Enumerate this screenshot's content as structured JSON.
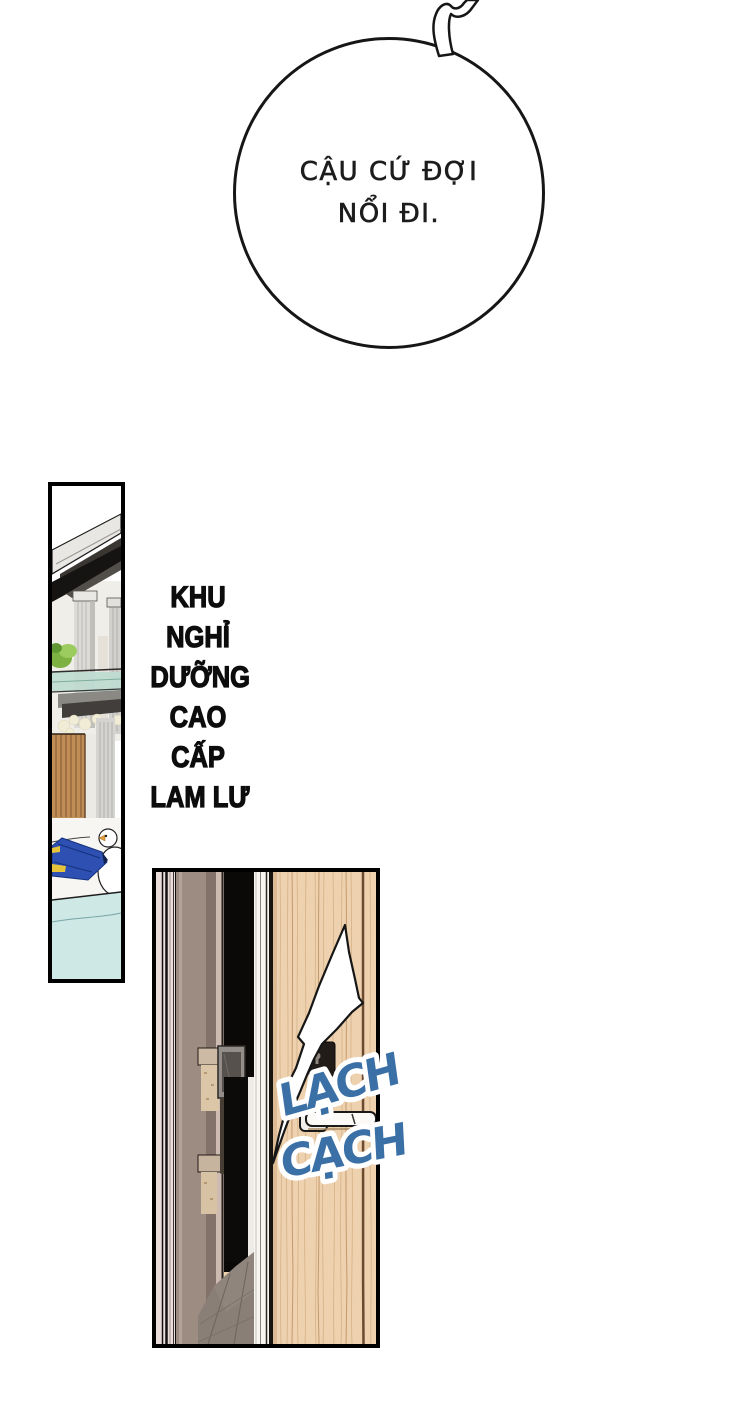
{
  "bubble": {
    "lines": [
      "CẬU CỨ ĐỢI",
      "NỔI ĐI."
    ]
  },
  "caption": {
    "lines": [
      "KHU",
      "NGHỈ",
      "DƯỠNG",
      "CAO",
      "CẤP",
      "LAM LƯ"
    ]
  },
  "sfx": {
    "word1": "LẠCH",
    "word2": "CẠCH",
    "color": "#3b70a6",
    "outline_color": "#ffffff"
  },
  "panels": {
    "resort": "narrow vertical panel: luxury resort exterior with roof, columns, glass balcony, wooden fence, duck float, blue lounger and swimming pool",
    "door": "panel: light wooden door with lever handle, white impact flash over lock, dark hallway and doorway at left"
  },
  "palette": {
    "ink": "#161616",
    "door_wood": "#eed1af",
    "wood_grain": "#c3996c",
    "pool_water": "#cde8e5",
    "glass_balcony": "#bfdbd1",
    "fence_wood": "#c08d57",
    "lounger_blue": "#2d50b2",
    "lounger_yellow": "#e5c43c",
    "hall_pillar": "#9d8c82",
    "hall_wall_pink": "#eadddc",
    "floor_gray": "#8a7f77"
  }
}
